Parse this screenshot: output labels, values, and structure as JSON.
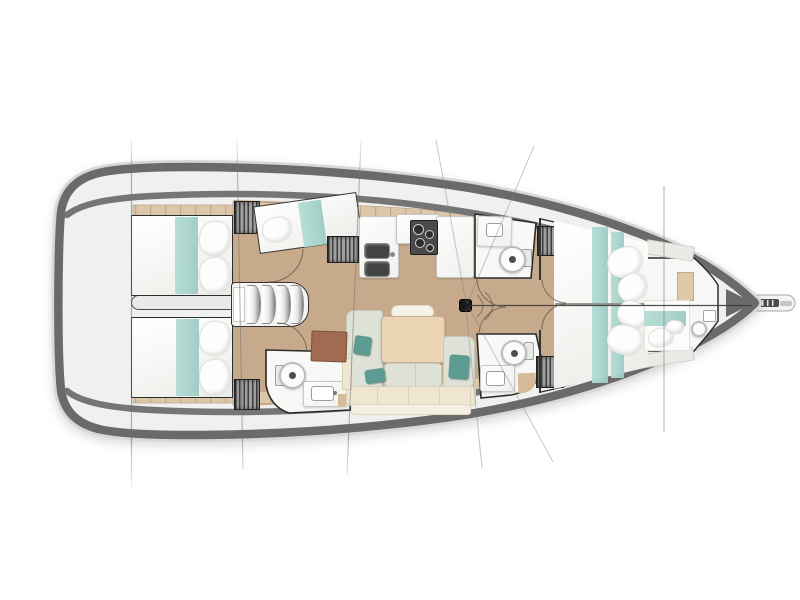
{
  "meta": {
    "title": "Sailing yacht interior deck plan, top view, bow pointing right",
    "type": "boat-floor-plan"
  },
  "colors": {
    "hull": "#6a6a6a",
    "hull_halo": "#d8d8d7",
    "deck": "#f0f0ef",
    "floor_wood": "#c7aa8b",
    "plank": "#dcc7a9",
    "plank_line": "#c3aa8a",
    "bed_white": "#fcfcfb",
    "teal": "#a9d5ce",
    "teal_dark": "#5d9b92",
    "sage": "#dde1d6",
    "cream": "#efe6d2",
    "table_wood": "#ebd4b3",
    "desk_brown": "#a06b51",
    "tan_corner": "#d6bb98",
    "room_white": "#f8f8f7",
    "outline": "#2c2c2c",
    "wardrobe_base": "#a0a0a0",
    "wardrobe_stripe": "#3e3e3e",
    "appliance": "#4a4a4a",
    "rig_line": "#6f6f6f",
    "stay": "#3c3c3c",
    "door_arc": "#6f5d49"
  },
  "layout": {
    "orientation": "bow-right",
    "rooms": [
      "cockpit-stern",
      "aft-cabin-port",
      "aft-cabin-starboard",
      "bunk-cabin-port",
      "companionway",
      "galley-port",
      "salon",
      "head-forward-port",
      "head-aft",
      "head-forward-starboard",
      "owner-cabin-vberth",
      "forepeak-cabin"
    ]
  },
  "elements": [
    {
      "n": "engine-compartment",
      "x": 131,
      "y": 295,
      "w": 112,
      "h": 15,
      "bg": "#eaeae9",
      "bd": "1.5px solid #4a4a4a",
      "rd": "8px 3px 3px 8px"
    },
    {
      "n": "aft-cabin-port-bed",
      "x": 131,
      "y": 215,
      "w": 102,
      "h": 81,
      "cl": "bed",
      "bd": "1.6px solid #2c2c2c"
    },
    {
      "n": "aft-cabin-port-runner",
      "x": 175,
      "y": 217,
      "w": 23,
      "h": 77,
      "cl": "teal-stripe"
    },
    {
      "n": "pillow",
      "x": 199,
      "y": 221,
      "w": 32,
      "h": 35,
      "r": 6,
      "cl": "pillow"
    },
    {
      "n": "pillow",
      "x": 199,
      "y": 257,
      "w": 32,
      "h": 36,
      "r": -7,
      "cl": "pillow"
    },
    {
      "n": "aft-cabin-starboard-bed",
      "x": 131,
      "y": 317,
      "w": 102,
      "h": 81,
      "cl": "bed",
      "bd": "1.6px solid #2c2c2c"
    },
    {
      "n": "aft-cabin-starboard-runner",
      "x": 176,
      "y": 319,
      "w": 23,
      "h": 77,
      "cl": "teal-stripe"
    },
    {
      "n": "pillow",
      "x": 199,
      "y": 321,
      "w": 32,
      "h": 35,
      "r": 7,
      "cl": "pillow"
    },
    {
      "n": "pillow",
      "x": 199,
      "y": 359,
      "w": 32,
      "h": 36,
      "r": -6,
      "cl": "pillow"
    },
    {
      "n": "wardrobe-aft-port",
      "x": 234,
      "y": 201,
      "w": 26,
      "h": 33,
      "cl": "wardrobe"
    },
    {
      "n": "wardrobe-aft-starboard",
      "x": 234,
      "y": 379,
      "w": 26,
      "h": 31,
      "cl": "wardrobe"
    },
    {
      "n": "bunk-cabin-berth",
      "x": 256,
      "y": 199,
      "w": 104,
      "h": 48,
      "r": -8,
      "cl": "bed",
      "bd": "1.4px solid #3a3a3a"
    },
    {
      "n": "bunk-cabin-runner",
      "x": 301,
      "y": 201,
      "w": 23,
      "h": 45,
      "r": -8,
      "cl": "teal-stripe"
    },
    {
      "n": "pillow",
      "x": 262,
      "y": 217,
      "w": 30,
      "h": 25,
      "r": -10,
      "cl": "pillow"
    },
    {
      "n": "wardrobe-mid-port",
      "x": 327,
      "y": 236,
      "w": 32,
      "h": 27,
      "cl": "wardrobe"
    },
    {
      "n": "companionway-steps",
      "x": 231,
      "y": 282,
      "w": 78,
      "h": 45,
      "bg": "#f4f4f3",
      "bd": "1.6px solid #333333",
      "rd": "4px 18px 18px 4px"
    },
    {
      "n": "step-tread",
      "x": 247,
      "y": 285,
      "w": 14,
      "h": 39,
      "cl": "tread"
    },
    {
      "n": "step-tread",
      "x": 262,
      "y": 285,
      "w": 14,
      "h": 39,
      "cl": "tread"
    },
    {
      "n": "step-tread",
      "x": 277,
      "y": 285,
      "w": 14,
      "h": 39,
      "cl": "tread"
    },
    {
      "n": "step-tread",
      "x": 291,
      "y": 285,
      "w": 13,
      "h": 39,
      "cl": "tread"
    },
    {
      "n": "companionway-landing",
      "x": 233,
      "y": 287,
      "w": 12,
      "h": 35,
      "bg": "#fdfdfc",
      "bd": "1px solid #c9c9c7"
    },
    {
      "n": "galley-counter-aft",
      "x": 359,
      "y": 216,
      "w": 40,
      "h": 62,
      "cl": "counter"
    },
    {
      "n": "galley-counter-mid",
      "x": 396,
      "y": 214,
      "w": 44,
      "h": 30,
      "cl": "counter"
    },
    {
      "n": "galley-counter-forward",
      "x": 436,
      "y": 216,
      "w": 38,
      "h": 62,
      "cl": "counter"
    },
    {
      "n": "galley-stove",
      "x": 410,
      "y": 220,
      "w": 28,
      "h": 35,
      "bg": "#4a4a4a",
      "bd": "1px solid #1e1e1e",
      "rd": "2px"
    },
    {
      "n": "stove-burner",
      "x": 413,
      "y": 224,
      "w": 11,
      "h": 11,
      "cl": "burner"
    },
    {
      "n": "stove-burner",
      "x": 425,
      "y": 230,
      "w": 9,
      "h": 9,
      "cl": "burner"
    },
    {
      "n": "stove-burner",
      "x": 415,
      "y": 238,
      "w": 10,
      "h": 10,
      "cl": "burner"
    },
    {
      "n": "stove-burner",
      "x": 426,
      "y": 244,
      "w": 8,
      "h": 8,
      "cl": "burner"
    },
    {
      "n": "galley-sink",
      "x": 364,
      "y": 243,
      "w": 26,
      "h": 16,
      "cl": "sink-dark"
    },
    {
      "n": "galley-sink",
      "x": 364,
      "y": 261,
      "w": 26,
      "h": 16,
      "cl": "sink-dark"
    },
    {
      "n": "galley-faucet",
      "x": 390,
      "y": 252,
      "w": 5,
      "h": 5,
      "bg": "#8b8b89",
      "rd": "50%"
    },
    {
      "n": "head-forward-port-counter",
      "x": 477,
      "y": 216,
      "w": 35,
      "h": 31,
      "r": 2,
      "cl": "counter"
    },
    {
      "n": "head-basin",
      "x": 486,
      "y": 223,
      "w": 17,
      "h": 14,
      "bg": "#ffffff",
      "bd": "1px solid #9d9d9b",
      "rd": "3px"
    },
    {
      "n": "toilet-tank",
      "x": 521,
      "y": 249,
      "w": 11,
      "h": 18,
      "bg": "#e9e9e7",
      "bd": "1px solid #a0a0a0",
      "rd": "2px"
    },
    {
      "n": "toilet",
      "x": 499,
      "y": 246,
      "w": 27,
      "h": 27,
      "cl": "toilet"
    },
    {
      "n": "toilet-flush",
      "x": 509,
      "y": 256,
      "w": 7,
      "h": 7,
      "bg": "#4c4c4c",
      "rd": "50%"
    },
    {
      "n": "wardrobe-forward-port",
      "x": 537,
      "y": 226,
      "w": 28,
      "h": 30,
      "cl": "wardrobe"
    },
    {
      "n": "toilet-tank",
      "x": 275,
      "y": 365,
      "w": 10,
      "h": 21,
      "bg": "#e9e9e7",
      "bd": "1px solid #a0a0a0",
      "rd": "2px"
    },
    {
      "n": "toilet",
      "x": 279,
      "y": 362,
      "w": 27,
      "h": 27,
      "cl": "toilet"
    },
    {
      "n": "toilet-flush",
      "x": 289,
      "y": 372,
      "w": 7,
      "h": 7,
      "bg": "#4c4c4c",
      "rd": "50%"
    },
    {
      "n": "head-aft-counter",
      "x": 303,
      "y": 381,
      "w": 45,
      "h": 26,
      "cl": "counter"
    },
    {
      "n": "head-basin",
      "x": 311,
      "y": 386,
      "w": 23,
      "h": 15,
      "bg": "#ffffff",
      "bd": "1px solid #9d9d9b",
      "rd": "3px"
    },
    {
      "n": "head-faucet",
      "x": 333,
      "y": 391,
      "w": 4,
      "h": 4,
      "bg": "#777777",
      "rd": "50%"
    },
    {
      "n": "shower-seat",
      "x": 338,
      "y": 394,
      "w": 12,
      "h": 13,
      "bg": "#d6bb98",
      "rd": "0 0 10px 0"
    },
    {
      "n": "toilet-tank",
      "x": 524,
      "y": 342,
      "w": 10,
      "h": 18,
      "bg": "#e9e9e7",
      "bd": "1px solid #a0a0a0",
      "rd": "2px"
    },
    {
      "n": "toilet",
      "x": 501,
      "y": 340,
      "w": 26,
      "h": 26,
      "cl": "toilet"
    },
    {
      "n": "toilet-flush",
      "x": 511,
      "y": 350,
      "w": 7,
      "h": 7,
      "bg": "#4c4c4c",
      "rd": "50%"
    },
    {
      "n": "head-forward-starboard-counter",
      "x": 480,
      "y": 365,
      "w": 35,
      "h": 27,
      "cl": "counter"
    },
    {
      "n": "head-basin",
      "x": 486,
      "y": 371,
      "w": 19,
      "h": 15,
      "bg": "#ffffff",
      "bd": "1px solid #9d9d9b",
      "rd": "3px"
    },
    {
      "n": "shower-seat",
      "x": 518,
      "y": 373,
      "w": 18,
      "h": 20,
      "r": -2,
      "bg": "#d6bb98",
      "rd": "0 0 14px 0"
    },
    {
      "n": "wardrobe-forward-starboard",
      "x": 536,
      "y": 356,
      "w": 28,
      "h": 32,
      "cl": "wardrobe"
    },
    {
      "n": "salon-seat-port",
      "x": 346,
      "y": 310,
      "w": 37,
      "h": 78,
      "cl": "cushion-sage",
      "rd": "8px 4px 4px 8px"
    },
    {
      "n": "salon-headrest",
      "x": 391,
      "y": 305,
      "w": 43,
      "h": 14,
      "bg": "#f6f3ea",
      "bd": "1px solid #ddd8c9",
      "rd": "7px"
    },
    {
      "n": "salon-table",
      "x": 381,
      "y": 316,
      "w": 64,
      "h": 47,
      "bg": "#ebd4b3",
      "bd": "1px solid #cdb28d",
      "rd": "4px",
      "sh": "0 1px 2px rgba(0,0,0,.25)"
    },
    {
      "n": "salon-mid-cushions",
      "x": 384,
      "y": 363,
      "w": 58,
      "h": 24,
      "cl": "cushion-sage seg"
    },
    {
      "n": "salon-seat-starboard",
      "x": 443,
      "y": 336,
      "w": 32,
      "h": 52,
      "cl": "cushion-sage",
      "rd": "4px 8px 8px 4px"
    },
    {
      "n": "salon-bench",
      "x": 346,
      "y": 386,
      "w": 130,
      "h": 20,
      "cl": "cushion-cream seg"
    },
    {
      "n": "salon-bench-back",
      "x": 351,
      "y": 404,
      "w": 120,
      "h": 11,
      "bg": "#f4efe2",
      "bd": "1px solid #e0d9c6",
      "rd": "3px"
    },
    {
      "n": "salon-shelf",
      "x": 342,
      "y": 358,
      "w": 10,
      "h": 32,
      "bg": "#efe6d2",
      "bd": "1px solid #d9d0ba"
    },
    {
      "n": "chart-table",
      "x": 311,
      "y": 331,
      "w": 36,
      "h": 31,
      "r": 2,
      "bg": "#a06b51",
      "bd": "1px solid #7d513a",
      "rd": "2px"
    },
    {
      "n": "teal-pillow",
      "x": 354,
      "y": 336,
      "w": 17,
      "h": 19,
      "r": 8,
      "cl": "teal-pillow"
    },
    {
      "n": "teal-pillow",
      "x": 365,
      "y": 369,
      "w": 20,
      "h": 14,
      "r": -8,
      "cl": "teal-pillow"
    },
    {
      "n": "teal-pillow",
      "x": 449,
      "y": 355,
      "w": 20,
      "h": 24,
      "r": 4,
      "cl": "teal-pillow"
    },
    {
      "n": "bulkhead",
      "x": 539,
      "y": 218,
      "w": 2,
      "h": 62,
      "bg": "#333333"
    },
    {
      "n": "bulkhead",
      "x": 539,
      "y": 330,
      "w": 2,
      "h": 63,
      "bg": "#333333"
    },
    {
      "n": "forward-shelf",
      "x": 646,
      "y": 243,
      "w": 48,
      "h": 15,
      "r": 9,
      "bg": "#eceae6",
      "bd": "1px solid #d2d0cc"
    },
    {
      "n": "forward-shelf",
      "x": 646,
      "y": 350,
      "w": 48,
      "h": 14,
      "r": -9,
      "bg": "#eceae6",
      "bd": "1px solid #d2d0cc"
    },
    {
      "n": "owner-cabin-berth",
      "x": 554,
      "y": 221,
      "w": 94,
      "h": 168,
      "cl": "bed",
      "cp": "polygon(0 0,100% 13%,100% 87%,0 100%)"
    },
    {
      "n": "owner-berth-runner",
      "x": 592,
      "y": 227,
      "w": 16,
      "h": 156,
      "cl": "teal-stripe"
    },
    {
      "n": "owner-berth-runner",
      "x": 611,
      "y": 232,
      "w": 13,
      "h": 146,
      "cl": "teal-stripe"
    },
    {
      "n": "owner-berth-foot-runner",
      "x": 622,
      "y": 306,
      "w": 22,
      "h": 13,
      "cl": "teal-stripe"
    },
    {
      "n": "owner-berth-split",
      "x": 555,
      "y": 303,
      "w": 92,
      "h": 2,
      "bg": "#97978f"
    },
    {
      "n": "pillow",
      "x": 607,
      "y": 247,
      "w": 36,
      "h": 30,
      "r": -16,
      "cl": "pillow"
    },
    {
      "n": "pillow",
      "x": 617,
      "y": 274,
      "w": 31,
      "h": 27,
      "r": -32,
      "cl": "pillow"
    },
    {
      "n": "pillow",
      "x": 617,
      "y": 301,
      "w": 31,
      "h": 27,
      "r": 32,
      "cl": "pillow"
    },
    {
      "n": "pillow",
      "x": 607,
      "y": 325,
      "w": 36,
      "h": 30,
      "r": 16,
      "cl": "pillow"
    },
    {
      "n": "forepeak-locker",
      "x": 677,
      "y": 272,
      "w": 17,
      "h": 29,
      "bg": "#dfc8a9",
      "bd": "1px solid #c4ab89"
    },
    {
      "n": "forepeak-berth",
      "x": 644,
      "y": 300,
      "w": 46,
      "h": 51,
      "bg": "#fcfcfb",
      "bd": "1px solid #e2e2df"
    },
    {
      "n": "forepeak-runner",
      "x": 644,
      "y": 311,
      "w": 42,
      "h": 15,
      "cl": "teal-stripe"
    },
    {
      "n": "pillow",
      "x": 648,
      "y": 328,
      "w": 26,
      "h": 19,
      "r": -8,
      "cl": "pillow"
    },
    {
      "n": "pillow",
      "x": 666,
      "y": 320,
      "w": 18,
      "h": 14,
      "r": 10,
      "cl": "pillow"
    },
    {
      "n": "forepeak-toilet",
      "x": 691,
      "y": 321,
      "w": 16,
      "h": 16,
      "cl": "toilet"
    },
    {
      "n": "forepeak-basin",
      "x": 703,
      "y": 310,
      "w": 13,
      "h": 12,
      "bg": "#ffffff",
      "bd": "1px solid #a5a5a3",
      "rd": "2px"
    },
    {
      "n": "mast",
      "x": 459,
      "y": 299,
      "w": 13,
      "h": 13,
      "bg": "#191919",
      "bd": "1px solid #000000",
      "rd": "3px"
    }
  ]
}
